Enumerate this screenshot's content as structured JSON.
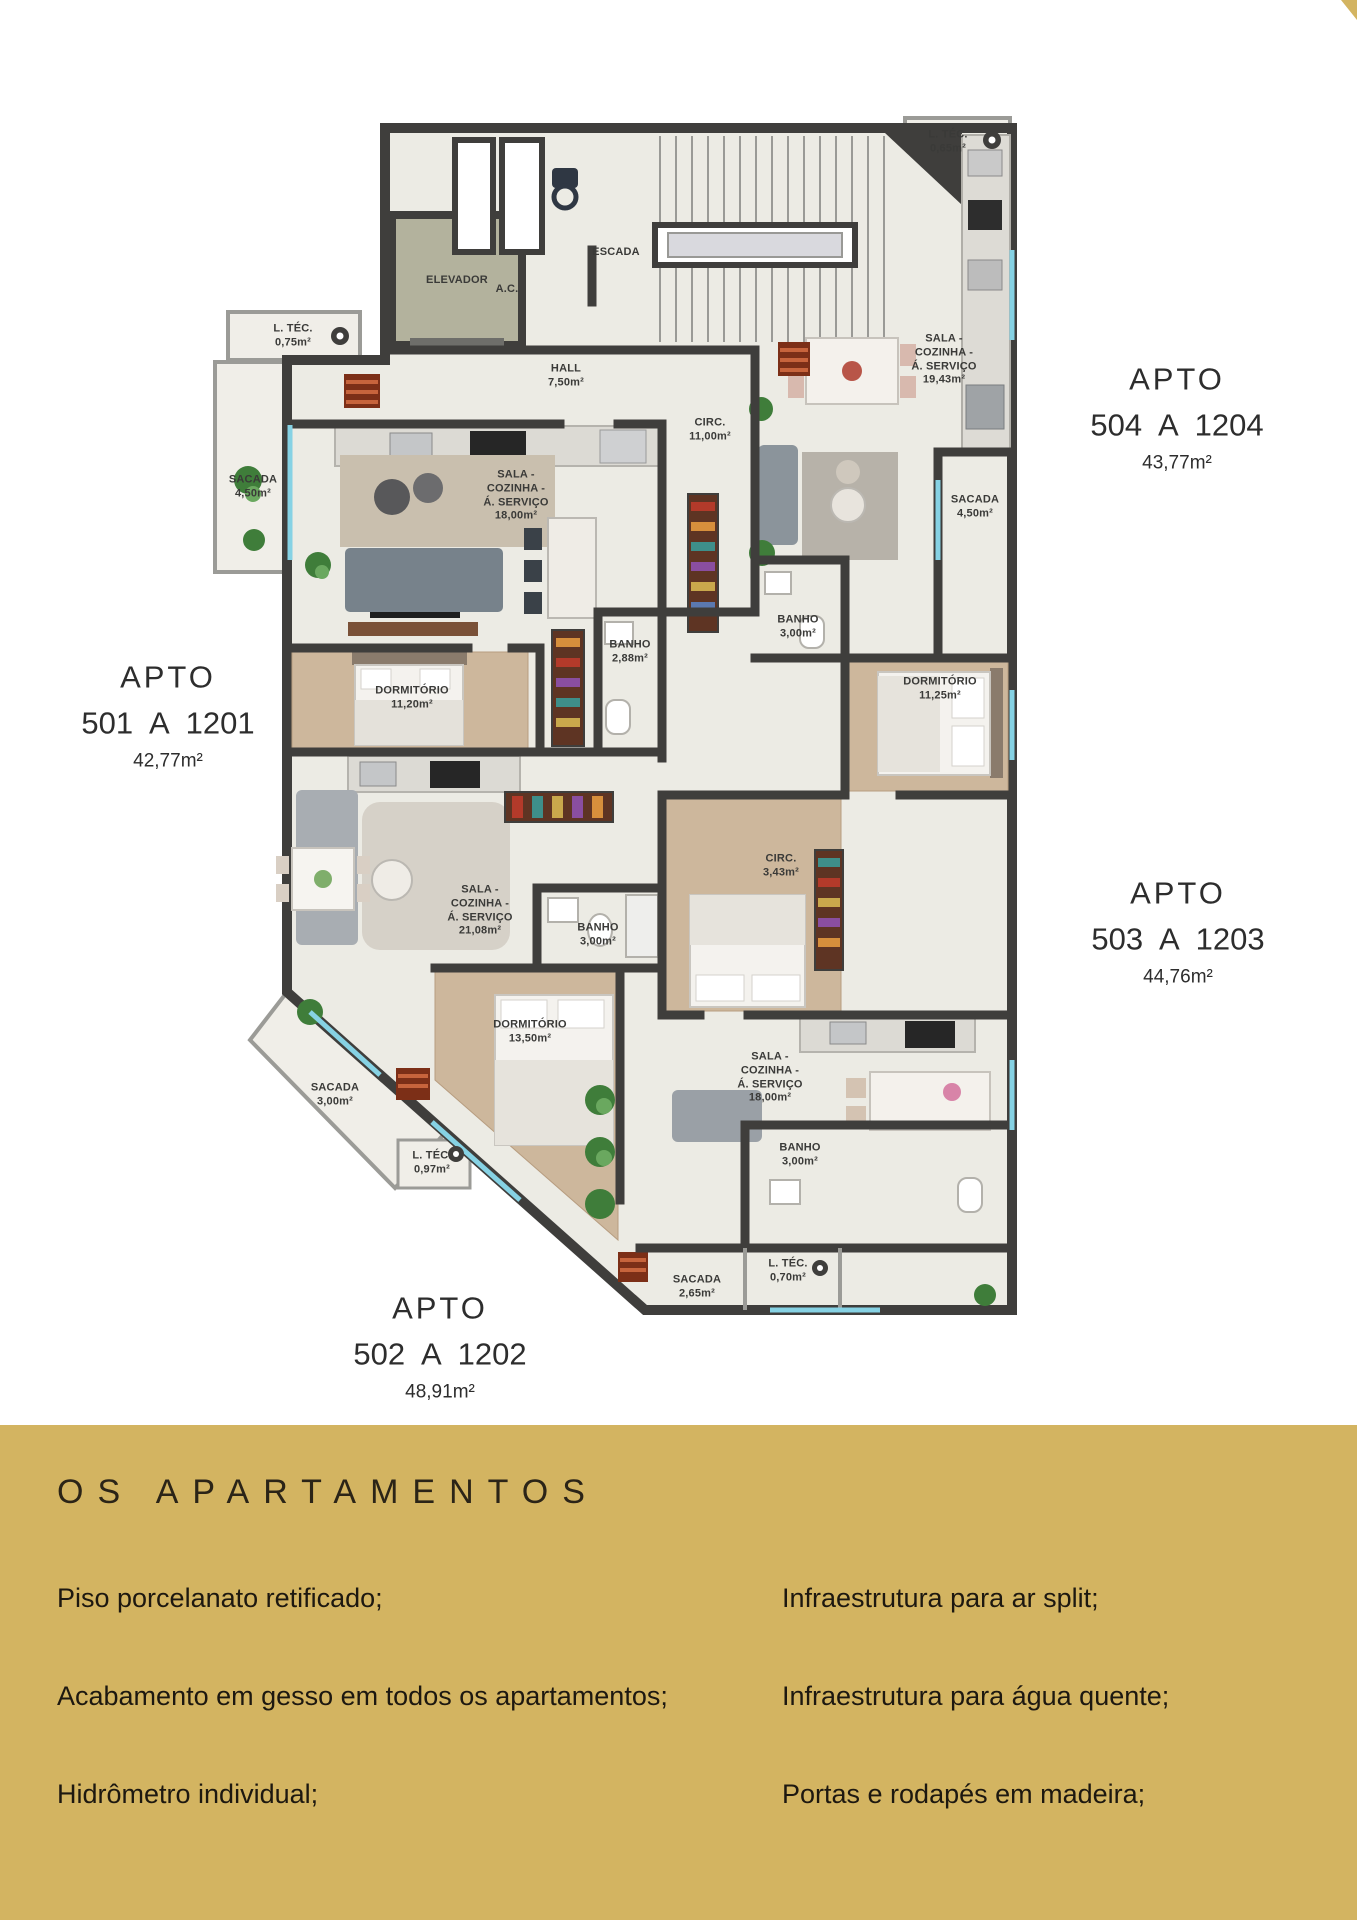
{
  "colors": {
    "accent_gold": "#d3b461",
    "wall": "#3f3e3c",
    "floor": "#ecebe4",
    "wood": "#cdb79c",
    "balcony": "#f0eee8",
    "window_glass": "#86d2e4"
  },
  "plan": {
    "apartments": [
      {
        "name": "APTO",
        "range": "501 A 1201",
        "area": "42,77m²"
      },
      {
        "name": "APTO",
        "range": "502 A 1202",
        "area": "48,91m²"
      },
      {
        "name": "APTO",
        "range": "503 A 1203",
        "area": "44,76m²"
      },
      {
        "name": "APTO",
        "range": "504 A 1204",
        "area": "43,77m²"
      }
    ],
    "rooms": [
      {
        "text": "ELEVADOR"
      },
      {
        "text": "ESCADA"
      },
      {
        "text": "A.C."
      },
      {
        "text": "L. TÉC.\n0,65m²"
      },
      {
        "text": "L. TÉC.\n0,75m²"
      },
      {
        "text": "HALL\n7,50m²"
      },
      {
        "text": "SALA -\nCOZINHA -\nÁ. SERVIÇO\n19,43m²"
      },
      {
        "text": "SACADA\n4,50m²"
      },
      {
        "text": "SALA -\nCOZINHA -\nÁ. SERVIÇO\n18,00m²"
      },
      {
        "text": "SACADA\n4,50m²"
      },
      {
        "text": "BANHO\n3,00m²"
      },
      {
        "text": "DORMITÓRIO\n11,25m²"
      },
      {
        "text": "BANHO\n2,88m²"
      },
      {
        "text": "CIRC.\n11,00m²"
      },
      {
        "text": "DORMITÓRIO\n11,20m²"
      },
      {
        "text": "CIRC.\n3,43m²"
      },
      {
        "text": "SALA -\nCOZINHA -\nÁ. SERVIÇO\n21,08m²"
      },
      {
        "text": "BANHO\n3,00m²"
      },
      {
        "text": "DORMITÓRIO\n13,50m²"
      },
      {
        "text": "SALA -\nCOZINHA -\nÁ. SERVIÇO\n18,00m²"
      },
      {
        "text": "SACADA\n3,00m²"
      },
      {
        "text": "L. TÉC.\n0,97m²"
      },
      {
        "text": "BANHO\n3,00m²"
      },
      {
        "text": "SACADA\n2,65m²"
      },
      {
        "text": "L. TÉC.\n0,70m²"
      }
    ]
  },
  "features": {
    "title": "OS APARTAMENTOS",
    "left": [
      "Piso porcelanato retificado;",
      "Acabamento em gesso em todos os apartamentos;",
      "Hidrômetro individual;"
    ],
    "right": [
      "Infraestrutura para ar split;",
      "Infraestrutura para água quente;",
      "Portas e rodapés em madeira;"
    ]
  }
}
